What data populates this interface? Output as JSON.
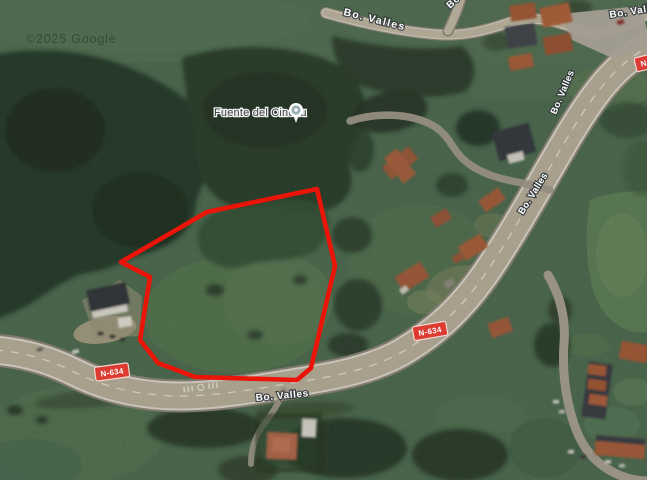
{
  "map": {
    "watermark": "©2025 Google",
    "poi": {
      "name": "Fuente del Cinchu"
    },
    "route_shield": "N-634",
    "road_labels": {
      "top": "Bo. Valles",
      "top_branch": "Bo",
      "upper_right": "Bo. Valles",
      "mid_right": "Bo. Valles",
      "bottom": "Bo. Valles",
      "corner": "Bo. Valles"
    },
    "colors": {
      "selection_outline": "#ea1408",
      "shield_red": "#dd3a31",
      "road_surface": "#bbb09a",
      "forest_dark": "#1f3420",
      "field_green": "#47684a"
    }
  }
}
